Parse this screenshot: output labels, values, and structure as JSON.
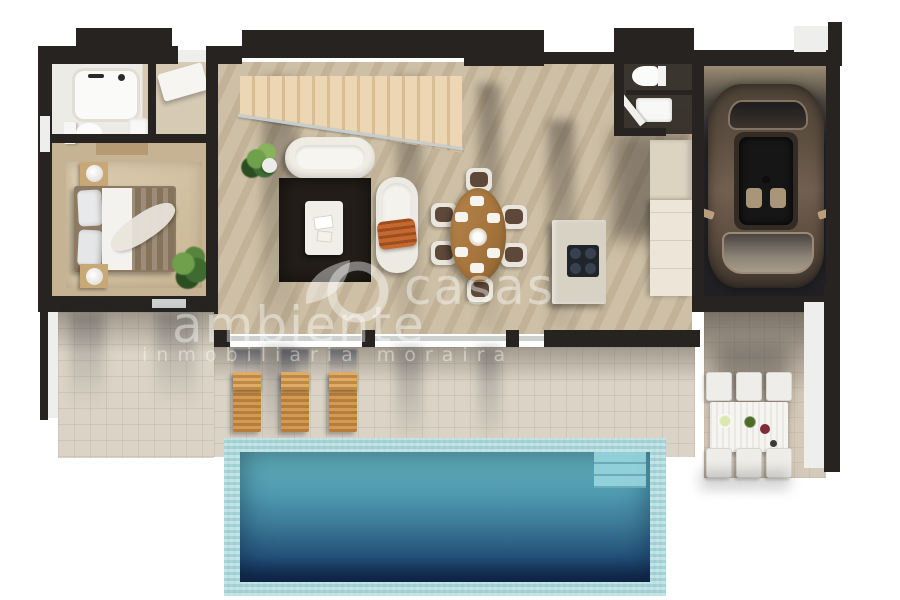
{
  "watermark": {
    "brand_word1": "casas",
    "brand_word2": "ambiente",
    "tagline": "inmobiliaria moraira"
  },
  "colors": {
    "wall": "#262320",
    "floor_main": "#cabb9f",
    "floor_bedroom": "#c6b394",
    "floor_bath": "#edebe6",
    "tile_terrace": "#dbd3c5",
    "tile_patio": "#d5c9b9",
    "pool_border": "#abd7da",
    "pool_water_top": "#63b1bd",
    "pool_water_deep": "#10264a",
    "lounger_wood": "#d39a55",
    "rug_dark": "#231e19",
    "blanket_orange": "#c9551d",
    "sofa_white": "#efece4",
    "table_wood": "#a5743c",
    "chair_cushion": "#5d4839",
    "island_top": "#d8d2c5",
    "cooktop": "#1f252b",
    "car_body": "#5d4f41",
    "car_roof": "#332c25",
    "garage_floor": "#26262a",
    "plant_green": "#4a7a36",
    "watermark_white": "rgba(255,255,255,0.42)"
  }
}
